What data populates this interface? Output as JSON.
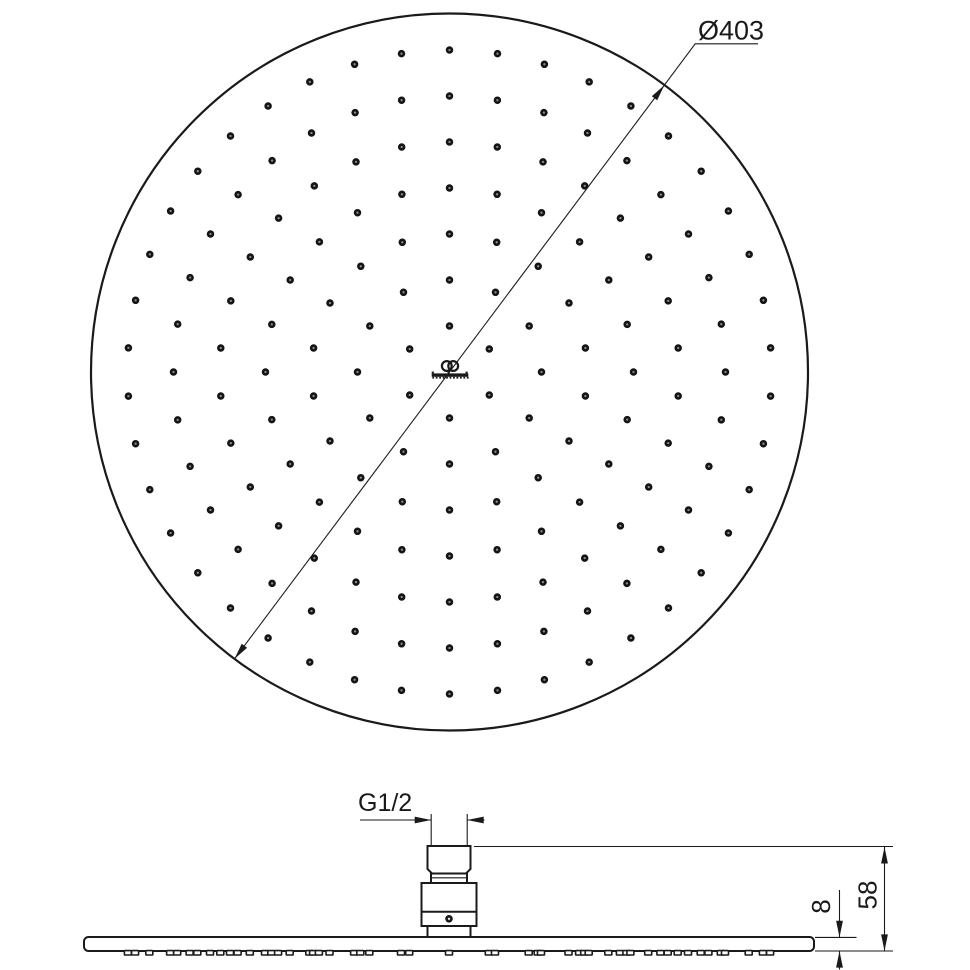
{
  "colors": {
    "background": "#ffffff",
    "line": "#1a1a1a",
    "dot_fill": "#141414",
    "dot_center": "#8d8d8d"
  },
  "drawing": {
    "top_view": {
      "diameter_label": "Ø403",
      "nozzles": {
        "rings": 7,
        "dots_per_ring_multiple": 6,
        "start_angle_deg": 90,
        "total": 168
      }
    },
    "side_view": {
      "thread_label": "G1/2",
      "height_label": "58",
      "plate_thickness_label": "8"
    },
    "logo": {
      "brand": "Ideal Standard"
    }
  }
}
